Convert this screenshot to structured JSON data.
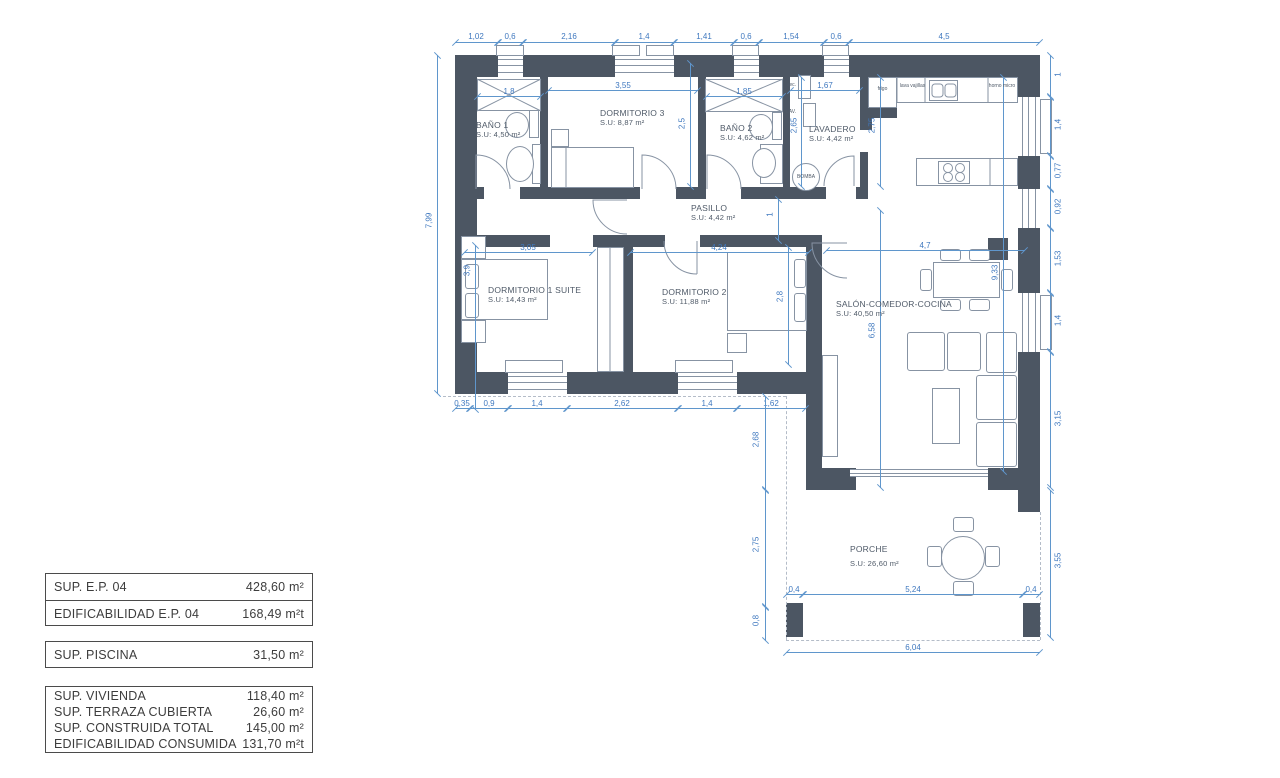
{
  "plan": {
    "rooms": [
      {
        "id": "bano1",
        "name": "BAÑO 1",
        "area": "S.U: 4,50 m²"
      },
      {
        "id": "dormitorio3",
        "name": "DORMITORIO 3",
        "area": "S.U: 8,87 m²"
      },
      {
        "id": "bano2",
        "name": "BAÑO 2",
        "area": "S.U: 4,62 m²"
      },
      {
        "id": "lavadero",
        "name": "LAVADERO",
        "area": "S.U: 4,42 m²"
      },
      {
        "id": "pasillo",
        "name": "PASILLO",
        "area": "S.U: 4,42 m²"
      },
      {
        "id": "dormitorio1",
        "name": "DORMITORIO 1 SUITE",
        "area": "S.U: 14,43 m²"
      },
      {
        "id": "dormitorio2",
        "name": "DORMITORIO 2",
        "area": "S.U: 11,88 m²"
      },
      {
        "id": "salon",
        "name": "SALÓN-COMEDOR-COCINA",
        "area": "S.U: 40,50 m²"
      },
      {
        "id": "porche",
        "name": "PORCHE",
        "area": "S.U: 26,60 m²"
      }
    ],
    "labels": {
      "sec": "sec.",
      "lav": "LAV.",
      "bomba": "BOMBA",
      "frigo": "frigo",
      "lavavajillas": "lava vajillas",
      "horno": "horno micro"
    },
    "dims": {
      "top": [
        "1,02",
        "0,6",
        "2,16",
        "1,4",
        "1,41",
        "0,6",
        "1,54",
        "0,6",
        "4,5"
      ],
      "left_total": "7,99",
      "right": [
        "1",
        "1,4",
        "0,77",
        "0,92",
        "1,53",
        "1,4",
        "3,15"
      ],
      "bottom": [
        "0,35",
        "0,9",
        "1,4",
        "2,62",
        "1,4",
        "1,62"
      ],
      "inner": {
        "bano1_w": "1,8",
        "dorm3_w": "3,55",
        "bano2_w": "1,85",
        "lav_w": "1,67",
        "dorm3_h": "2,5",
        "lav_h": "2,65",
        "cocina_h": "2,75",
        "dorm1_w": "3,05",
        "dorm2_w": "4,24",
        "dorm1_h": "3,9",
        "dorm2_h": "2,8",
        "pasillo_h": "1",
        "salon_w": "4,7",
        "salon_h": "6,58",
        "salon_total": "9,33"
      },
      "porch": {
        "upper_left": "2,68",
        "left": "2,75",
        "pillar_h": "0,8",
        "offset_l": "0,4",
        "span": "5,24",
        "offset_r": "0,4",
        "width": "6,04",
        "right": "3,55"
      }
    }
  },
  "summary": {
    "block1": [
      {
        "label": "SUP. E.P. 04",
        "value": "428,60 m²"
      },
      {
        "label": "EDIFICABILIDAD E.P. 04",
        "value": "168,49 m²t"
      }
    ],
    "block2": [
      {
        "label": "SUP. PISCINA",
        "value": "31,50 m²"
      }
    ],
    "block3": [
      {
        "label": "SUP. VIVIENDA",
        "value": "118,40 m²"
      },
      {
        "label": "SUP. TERRAZA CUBIERTA",
        "value": "26,60 m²"
      },
      {
        "label": "SUP. CONSTRUIDA TOTAL",
        "value": "145,00 m²"
      },
      {
        "label": "EDIFICABILIDAD CONSUMIDA",
        "value": "131,70 m²t"
      }
    ]
  },
  "colors": {
    "wall": "#4c5663",
    "dim": "#5f96cc",
    "dimText": "#3f78bf",
    "furniture": "#8793a3",
    "roomText": "#4f5a68",
    "dashed": "#b4bcc8"
  }
}
